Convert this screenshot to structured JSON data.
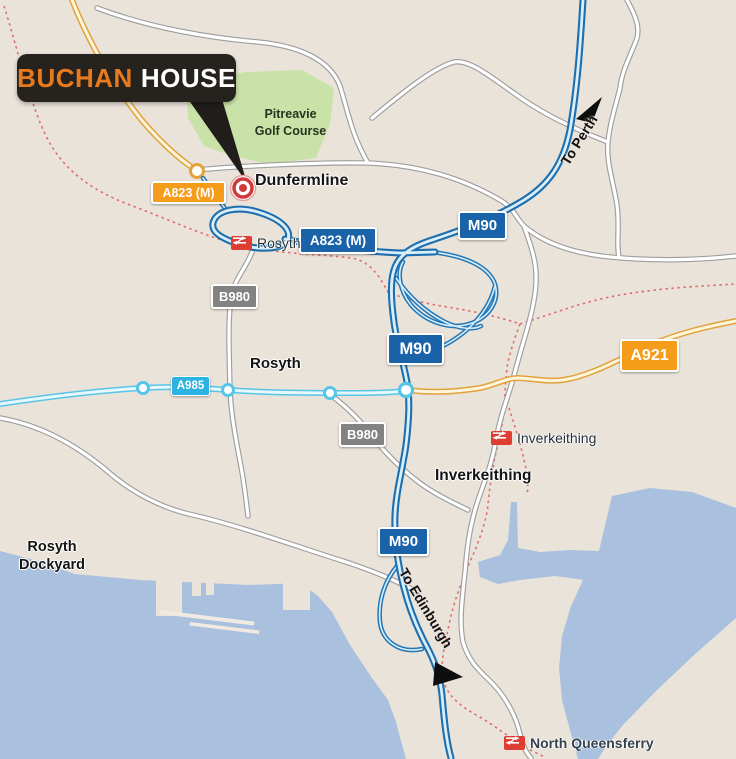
{
  "callout": {
    "primary": "BUCHAN",
    "secondary": "HOUSE"
  },
  "places": {
    "dunfermline": "Dunfermline",
    "rosyth_town": "Rosyth",
    "inverkeithing_town": "Inverkeithing",
    "rosyth_dockyard_line1": "Rosyth",
    "rosyth_dockyard_line2": "Dockyard",
    "golf_course_line1": "Pitreavie",
    "golf_course_line2": "Golf Course"
  },
  "stations": [
    {
      "name": "Rosyth"
    },
    {
      "name": "Inverkeithing"
    },
    {
      "name": "North Queensferry"
    }
  ],
  "road_badges": {
    "a823m": "A823 (M)",
    "m90": "M90",
    "b980": "B980",
    "a985": "A985",
    "a921": "A921"
  },
  "directions": {
    "to_perth": "To Perth",
    "to_edinburgh": "To Edinburgh"
  },
  "colors": {
    "land": "#eae3da",
    "water": "#a9c1de",
    "golf_green": "#c9e2a8",
    "motorway_blue": "#1e6fad",
    "a_road_yellow": "#e2a23c",
    "a985_cyan": "#2cb3e2",
    "b_road_gray": "#828282",
    "railway_red": "#e06c6c",
    "badge_blue": "#1a63a8",
    "badge_orange": "#f59c1b",
    "callout_bg": "#26231f",
    "callout_accent": "#e87a1d",
    "marker_red": "#cf3a3a"
  }
}
